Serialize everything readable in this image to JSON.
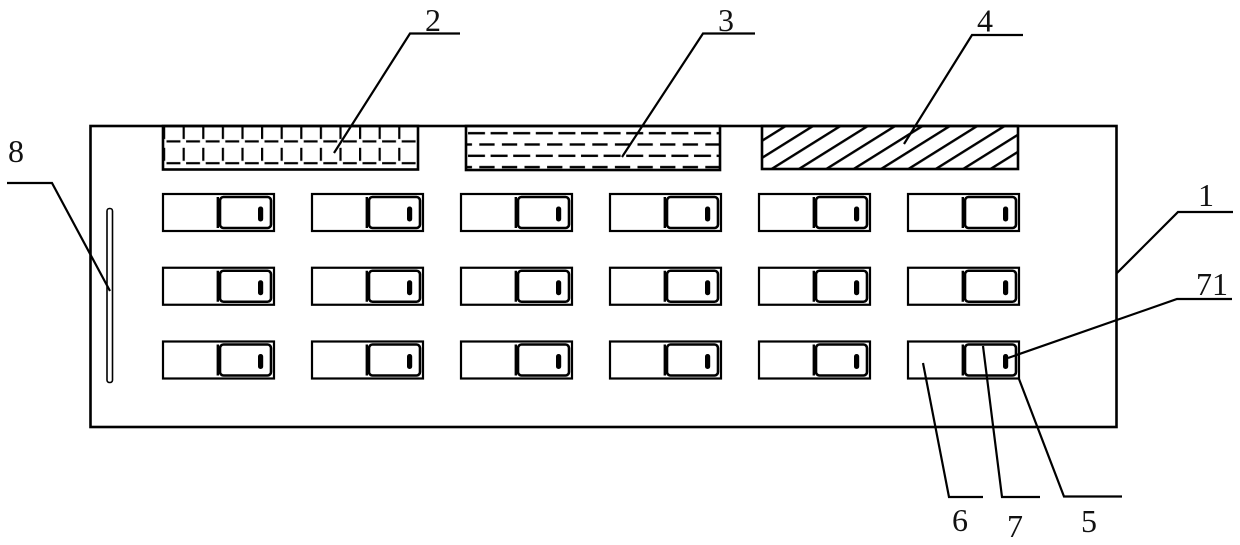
{
  "figure": {
    "kind": "technical-drawing",
    "description": "Panel front view with three hatched zones, 3x6 grid of slide switches, side strip and numbered leader lines",
    "reference_labels": {
      "panel": "1",
      "brick_region": "2",
      "dashed_region": "3",
      "hatched_region": "4",
      "switch_housing": "5",
      "switch_body": "6",
      "switch_slider": "7",
      "slider_indicator": "71",
      "side_strip": "8"
    },
    "switch_grid": {
      "rows": 3,
      "columns": 6
    },
    "colors": {
      "line": "#000000",
      "background": "#ffffff",
      "label_ink": "#111111"
    }
  }
}
